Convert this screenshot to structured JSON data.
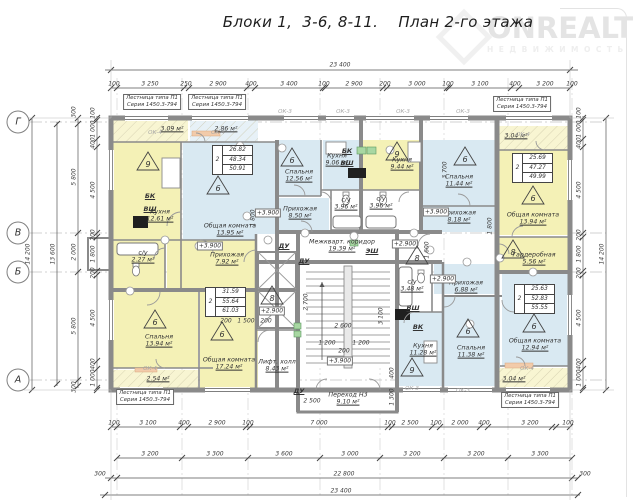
{
  "title": "Блоки 1,  3-6, 8-11.    План 2-го этажа",
  "watermark": {
    "line1": "ONREALT",
    "line2": "НЕДВИЖИМОСТЬ"
  },
  "colors": {
    "room_yellow": "#f4f1b6",
    "room_blue": "#d9e9f2",
    "balcony_yellow": "#f8f5d2",
    "balcony_blue": "#e7f1f7",
    "wall_gray": "#8a8a8a"
  },
  "axes": [
    {
      "label": "Г",
      "y": 122
    },
    {
      "label": "В",
      "y": 233
    },
    {
      "label": "Б",
      "y": 272
    },
    {
      "label": "А",
      "y": 380
    }
  ],
  "rooms": [
    {
      "id": "balcony-tl-1",
      "name": "",
      "area": "3.09 м²",
      "x": 113,
      "y": 120,
      "w": 75,
      "h": 22,
      "f": "by",
      "lx": 172,
      "ly": 129
    },
    {
      "id": "balcony-tl-2",
      "name": "",
      "area": "2.86 м²",
      "x": 190,
      "y": 120,
      "w": 68,
      "h": 22,
      "f": "bb",
      "lx": 226,
      "ly": 129
    },
    {
      "id": "balcony-tr",
      "name": "",
      "area": "3.04 м²",
      "x": 499,
      "y": 126,
      "w": 71,
      "h": 24,
      "f": "by",
      "lx": 516,
      "ly": 136
    },
    {
      "id": "kitchen-tl",
      "name": "Кухня",
      "area": "12.61 м²",
      "x": 113,
      "y": 142,
      "w": 68,
      "h": 98,
      "f": "y",
      "lx": 160,
      "ly": 216
    },
    {
      "id": "living-tl",
      "name": "Общая комната",
      "area": "13.95 м²",
      "x": 183,
      "y": 142,
      "w": 94,
      "h": 98,
      "f": "b",
      "lx": 230,
      "ly": 230
    },
    {
      "id": "bedroom-ml",
      "name": "Спальня",
      "area": "12.56 м²",
      "x": 279,
      "y": 140,
      "w": 42,
      "h": 56,
      "f": "b",
      "lx": 299,
      "ly": 176
    },
    {
      "id": "kitchen-ml",
      "name": "Кухня",
      "area": "9.06 м²",
      "x": 323,
      "y": 140,
      "w": 38,
      "h": 50,
      "f": "b",
      "lx": 337,
      "ly": 160
    },
    {
      "id": "kitchen-mr",
      "name": "Кухня",
      "area": "9.44 м²",
      "x": 363,
      "y": 140,
      "w": 58,
      "h": 50,
      "f": "y",
      "lx": 402,
      "ly": 164
    },
    {
      "id": "bath-ml",
      "name": "с/у",
      "area": "3.96 м²",
      "x": 331,
      "y": 192,
      "w": 30,
      "h": 38,
      "f": "w",
      "lx": 346,
      "ly": 204
    },
    {
      "id": "bath-mr",
      "name": "с/у",
      "area": "3.96 м²",
      "x": 363,
      "y": 192,
      "w": 36,
      "h": 38,
      "f": "w",
      "lx": 381,
      "ly": 203
    },
    {
      "id": "hall-ml",
      "name": "Прихожая",
      "area": "8.50 м²",
      "x": 279,
      "y": 198,
      "w": 50,
      "h": 34,
      "f": "b",
      "lx": 300,
      "ly": 213
    },
    {
      "id": "bedroom-r",
      "name": "Спальня",
      "area": "11.44 м²",
      "x": 423,
      "y": 140,
      "w": 74,
      "h": 66,
      "f": "b",
      "lx": 459,
      "ly": 181
    },
    {
      "id": "hall-r",
      "name": "Прихожая",
      "area": "8.18 м²",
      "x": 423,
      "y": 206,
      "w": 74,
      "h": 26,
      "f": "b",
      "lx": 459,
      "ly": 217
    },
    {
      "id": "living-tr",
      "name": "Общая комната",
      "area": "13.94 м²",
      "x": 499,
      "y": 150,
      "w": 69,
      "h": 85,
      "f": "y",
      "lx": 533,
      "ly": 219
    },
    {
      "id": "wardrobe-tr",
      "name": "Гардеробная",
      "area": "5.56 м²",
      "x": 499,
      "y": 237,
      "w": 69,
      "h": 35,
      "f": "y",
      "lx": 534,
      "ly": 259
    },
    {
      "id": "corridor",
      "name": "Межкварт. коридор",
      "area": "19.39 м²",
      "x": 298,
      "y": 234,
      "w": 144,
      "h": 28,
      "f": "w",
      "lx": 342,
      "ly": 246
    },
    {
      "id": "lift-hall",
      "name": "Лифт. холл",
      "area": "8.43 м²",
      "x": 256,
      "y": 330,
      "w": 42,
      "h": 58,
      "f": "w",
      "lx": 277,
      "ly": 366
    },
    {
      "id": "passage",
      "name": "Переход Н3",
      "area": "9.10 м²",
      "x": 298,
      "y": 388,
      "w": 99,
      "h": 24,
      "f": "w",
      "lx": 348,
      "ly": 399
    },
    {
      "id": "bath-bl",
      "name": "с/у",
      "area": "2.27 м²",
      "x": 113,
      "y": 240,
      "w": 52,
      "h": 50,
      "f": "y",
      "lx": 143,
      "ly": 257
    },
    {
      "id": "hall-bl",
      "name": "Прихожая",
      "area": "7.92 м²",
      "x": 167,
      "y": 240,
      "w": 89,
      "h": 50,
      "f": "y",
      "lx": 227,
      "ly": 259
    },
    {
      "id": "bedroom-bl",
      "name": "Спальня",
      "area": "13.94 м²",
      "x": 113,
      "y": 292,
      "w": 85,
      "h": 76,
      "f": "y",
      "lx": 159,
      "ly": 341
    },
    {
      "id": "living-bl",
      "name": "Общая комната",
      "area": "17.24 м²",
      "x": 200,
      "y": 292,
      "w": 58,
      "h": 98,
      "f": "y",
      "lx": 229,
      "ly": 364
    },
    {
      "id": "balcony-bl",
      "name": "",
      "area": "2.54 м²",
      "x": 113,
      "y": 370,
      "w": 85,
      "h": 18,
      "f": "by",
      "lx": 158,
      "ly": 379
    },
    {
      "id": "kitchen-br",
      "name": "Кухня",
      "area": "11.28 м²",
      "x": 398,
      "y": 312,
      "w": 44,
      "h": 74,
      "f": "b",
      "lx": 423,
      "ly": 350
    },
    {
      "id": "bath-br",
      "name": "с/у",
      "area": "3.48 м²",
      "x": 398,
      "y": 264,
      "w": 34,
      "h": 46,
      "f": "w",
      "lx": 412,
      "ly": 286
    },
    {
      "id": "bedroom-br",
      "name": "Спальня",
      "area": "11.38 м²",
      "x": 444,
      "y": 296,
      "w": 56,
      "h": 90,
      "f": "b",
      "lx": 471,
      "ly": 352
    },
    {
      "id": "hall-br",
      "name": "Прихожая",
      "area": "6.88 м²",
      "x": 434,
      "y": 264,
      "w": 64,
      "h": 30,
      "f": "b",
      "lx": 466,
      "ly": 287
    },
    {
      "id": "living-br",
      "name": "Общая комната",
      "area": "12.94 м²",
      "x": 502,
      "y": 274,
      "w": 66,
      "h": 92,
      "f": "b",
      "lx": 535,
      "ly": 345
    },
    {
      "id": "balcony-br",
      "name": "",
      "area": "3.04 м²",
      "x": 499,
      "y": 368,
      "w": 71,
      "h": 20,
      "f": "by",
      "lx": 514,
      "ly": 379
    },
    {
      "id": "stairwell",
      "name": "",
      "area": "",
      "x": 300,
      "y": 264,
      "w": 95,
      "h": 104,
      "f": "w",
      "lx": 0,
      "ly": 0
    },
    {
      "id": "lift-zone",
      "name": "",
      "area": "",
      "x": 256,
      "y": 234,
      "w": 42,
      "h": 96,
      "f": "w",
      "lx": 0,
      "ly": 0
    }
  ],
  "triangles": [
    [
      "9",
      148,
      163
    ],
    [
      "6",
      218,
      187
    ],
    [
      "6",
      292,
      159
    ],
    [
      "9",
      397,
      153
    ],
    [
      "6",
      465,
      158
    ],
    [
      "6",
      533,
      197
    ],
    [
      "8",
      513,
      251
    ],
    [
      "8",
      417,
      257
    ],
    [
      "8",
      272,
      297
    ],
    [
      "6",
      155,
      321
    ],
    [
      "6",
      222,
      333
    ],
    [
      "6",
      468,
      330
    ],
    [
      "6",
      534,
      325
    ],
    [
      "9",
      412,
      369
    ]
  ],
  "apt_tables": [
    {
      "x": 212,
      "y": 145,
      "rooms": "2",
      "values": [
        "26.82",
        "48.34",
        "50.91"
      ]
    },
    {
      "x": 205,
      "y": 287,
      "rooms": "2",
      "values": [
        "31.59",
        "55.64",
        "61.03"
      ]
    },
    {
      "x": 512,
      "y": 153,
      "rooms": "2",
      "values": [
        "25.69",
        "47.27",
        "49.99"
      ]
    },
    {
      "x": 514,
      "y": 284,
      "rooms": "2",
      "values": [
        "25.63",
        "52.83",
        "55.55"
      ]
    }
  ],
  "dim_labels": [
    [
      "23 400",
      340,
      65,
      0
    ],
    [
      "100",
      114,
      84,
      0
    ],
    [
      "3 250",
      150,
      84,
      0
    ],
    [
      "250",
      186,
      84,
      0
    ],
    [
      "2 900",
      218,
      84,
      0
    ],
    [
      "400",
      251,
      84,
      0
    ],
    [
      "3 400",
      289,
      84,
      0
    ],
    [
      "100",
      324,
      84,
      0
    ],
    [
      "2 900",
      354,
      84,
      0
    ],
    [
      "200",
      385,
      84,
      0
    ],
    [
      "3 000",
      417,
      84,
      0
    ],
    [
      "100",
      448,
      84,
      0
    ],
    [
      "3 100",
      480,
      84,
      0
    ],
    [
      "400",
      515,
      84,
      0
    ],
    [
      "3 200",
      545,
      84,
      0
    ],
    [
      "100",
      572,
      84,
      0
    ],
    [
      "100",
      114,
      423,
      0
    ],
    [
      "3 100",
      148,
      423,
      0
    ],
    [
      "400",
      184,
      423,
      0
    ],
    [
      "2 900",
      217,
      423,
      0
    ],
    [
      "100",
      248,
      423,
      0
    ],
    [
      "7 000",
      319,
      423,
      0
    ],
    [
      "100",
      390,
      423,
      0
    ],
    [
      "2 500",
      410,
      423,
      0
    ],
    [
      "100",
      436,
      423,
      0
    ],
    [
      "2 000",
      460,
      423,
      0
    ],
    [
      "400",
      484,
      423,
      0
    ],
    [
      "3 200",
      530,
      423,
      0
    ],
    [
      "100",
      568,
      423,
      0
    ],
    [
      "3 200",
      150,
      454,
      0
    ],
    [
      "3 300",
      215,
      454,
      0
    ],
    [
      "3 600",
      284,
      454,
      0
    ],
    [
      "3 000",
      350,
      454,
      0
    ],
    [
      "3 200",
      412,
      454,
      0
    ],
    [
      "3 200",
      476,
      454,
      0
    ],
    [
      "3 300",
      540,
      454,
      0
    ],
    [
      "300",
      100,
      474,
      0
    ],
    [
      "22 800",
      344,
      474,
      0
    ],
    [
      "300",
      585,
      474,
      0
    ],
    [
      "23 400",
      341,
      491,
      0
    ],
    [
      "14 200",
      28,
      254,
      90
    ],
    [
      "13 600",
      53,
      254,
      90
    ],
    [
      "300",
      74,
      112,
      90
    ],
    [
      "5 800",
      74,
      177,
      90
    ],
    [
      "2 000",
      74,
      252,
      90
    ],
    [
      "5 800",
      74,
      326,
      90
    ],
    [
      "300",
      74,
      387,
      90
    ],
    [
      "100",
      93,
      113,
      90
    ],
    [
      "1 000",
      93,
      129,
      90
    ],
    [
      "400",
      93,
      143,
      90
    ],
    [
      "4 500",
      93,
      190,
      90
    ],
    [
      "200",
      93,
      235,
      90
    ],
    [
      "1 800",
      93,
      254,
      90
    ],
    [
      "200",
      93,
      273,
      90
    ],
    [
      "4 500",
      93,
      318,
      90
    ],
    [
      "400",
      93,
      364,
      90
    ],
    [
      "1 000",
      93,
      378,
      90
    ],
    [
      "100",
      579,
      113,
      90
    ],
    [
      "1 000",
      579,
      129,
      90
    ],
    [
      "400",
      579,
      143,
      90
    ],
    [
      "4 500",
      579,
      190,
      90
    ],
    [
      "200",
      579,
      235,
      90
    ],
    [
      "1 800",
      579,
      254,
      90
    ],
    [
      "200",
      579,
      273,
      90
    ],
    [
      "4 500",
      579,
      318,
      90
    ],
    [
      "400",
      579,
      364,
      90
    ],
    [
      "1 000",
      579,
      378,
      90
    ],
    [
      "14 200",
      602,
      254,
      90
    ],
    [
      "3 700",
      445,
      170,
      90
    ],
    [
      "1 800",
      253,
      218,
      90
    ],
    [
      "1 600",
      427,
      250,
      90
    ],
    [
      "1 800",
      490,
      226,
      90
    ],
    [
      "2 600",
      343,
      326,
      0
    ],
    [
      "1 200",
      327,
      343,
      0
    ],
    [
      "1 200",
      361,
      343,
      0
    ],
    [
      "200",
      344,
      351,
      0
    ],
    [
      "3 100",
      381,
      316,
      90
    ],
    [
      "2 700",
      306,
      302,
      90
    ],
    [
      "200",
      226,
      321,
      0
    ],
    [
      "1 500",
      246,
      321,
      0
    ],
    [
      "200",
      266,
      321,
      0
    ],
    [
      "2 500",
      312,
      401,
      0
    ],
    [
      "1 300",
      392,
      397,
      90
    ],
    [
      "400",
      392,
      373,
      90
    ]
  ],
  "labels": [
    {
      "t": "Лестница типа П1",
      "t2": "Серия 1450.3-794",
      "x": 152,
      "y": 102,
      "c": "stairlbl"
    },
    {
      "t": "Лестница типа П1",
      "t2": "Серия 1450.3-794",
      "x": 217,
      "y": 102,
      "c": "stairlbl"
    },
    {
      "t": "Лестница типа П1",
      "t2": "Серия 1450.3-794",
      "x": 522,
      "y": 104,
      "c": "stairlbl"
    },
    {
      "t": "Лестница типа П1",
      "t2": "Серия 1450.3-794",
      "x": 145,
      "y": 397,
      "c": "stairlbl"
    },
    {
      "t": "Лестница типа П1",
      "t2": "Серия 1450.3-794",
      "x": 530,
      "y": 400,
      "c": "stairlbl"
    },
    {
      "t": "БК",
      "x": 150,
      "y": 196,
      "c": "eq"
    },
    {
      "t": "ВШ",
      "x": 150,
      "y": 209,
      "c": "eq"
    },
    {
      "t": "БК",
      "x": 347,
      "y": 151,
      "c": "eq"
    },
    {
      "t": "ВШ",
      "x": 347,
      "y": 163,
      "c": "eq"
    },
    {
      "t": "ВШ",
      "x": 413,
      "y": 308,
      "c": "eq"
    },
    {
      "t": "ВК",
      "x": 418,
      "y": 327,
      "c": "eq"
    },
    {
      "t": "ЭШ",
      "x": 372,
      "y": 251,
      "c": "eq"
    },
    {
      "t": "ДУ",
      "x": 284,
      "y": 246,
      "c": "eq"
    },
    {
      "t": "ДУ",
      "x": 304,
      "y": 261,
      "c": "eq"
    },
    {
      "t": "ДУ",
      "x": 299,
      "y": 391,
      "c": "eq"
    },
    {
      "t": "ОК-4",
      "x": 155,
      "y": 133,
      "c": "ok"
    },
    {
      "t": "ОК-4",
      "x": 218,
      "y": 133,
      "c": "ok"
    },
    {
      "t": "ОК-3",
      "x": 285,
      "y": 112,
      "c": "ok"
    },
    {
      "t": "ОК-3",
      "x": 343,
      "y": 112,
      "c": "ok"
    },
    {
      "t": "ОК-3",
      "x": 403,
      "y": 112,
      "c": "ok"
    },
    {
      "t": "ОК-3",
      "x": 463,
      "y": 112,
      "c": "ok"
    },
    {
      "t": "ОК-4",
      "x": 523,
      "y": 135,
      "c": "ok"
    },
    {
      "t": "ОК-4",
      "x": 150,
      "y": 369,
      "c": "ok"
    },
    {
      "t": "ОК-3",
      "x": 412,
      "y": 389,
      "c": "ok"
    },
    {
      "t": "ОК-3",
      "x": 463,
      "y": 391,
      "c": "ok"
    },
    {
      "t": "ОК-4",
      "x": 527,
      "y": 369,
      "c": "ok"
    },
    {
      "t": "+3.900",
      "x": 268,
      "y": 213,
      "c": "elev"
    },
    {
      "t": "+3.900",
      "x": 210,
      "y": 246,
      "c": "elev"
    },
    {
      "t": "+3.900",
      "x": 340,
      "y": 361,
      "c": "elev"
    },
    {
      "t": "+3.900",
      "x": 436,
      "y": 212,
      "c": "elev"
    },
    {
      "t": "+2.900",
      "x": 405,
      "y": 244,
      "c": "elev"
    },
    {
      "t": "+2.900",
      "x": 272,
      "y": 311,
      "c": "elev"
    },
    {
      "t": "+2.900",
      "x": 443,
      "y": 279,
      "c": "elev"
    }
  ]
}
